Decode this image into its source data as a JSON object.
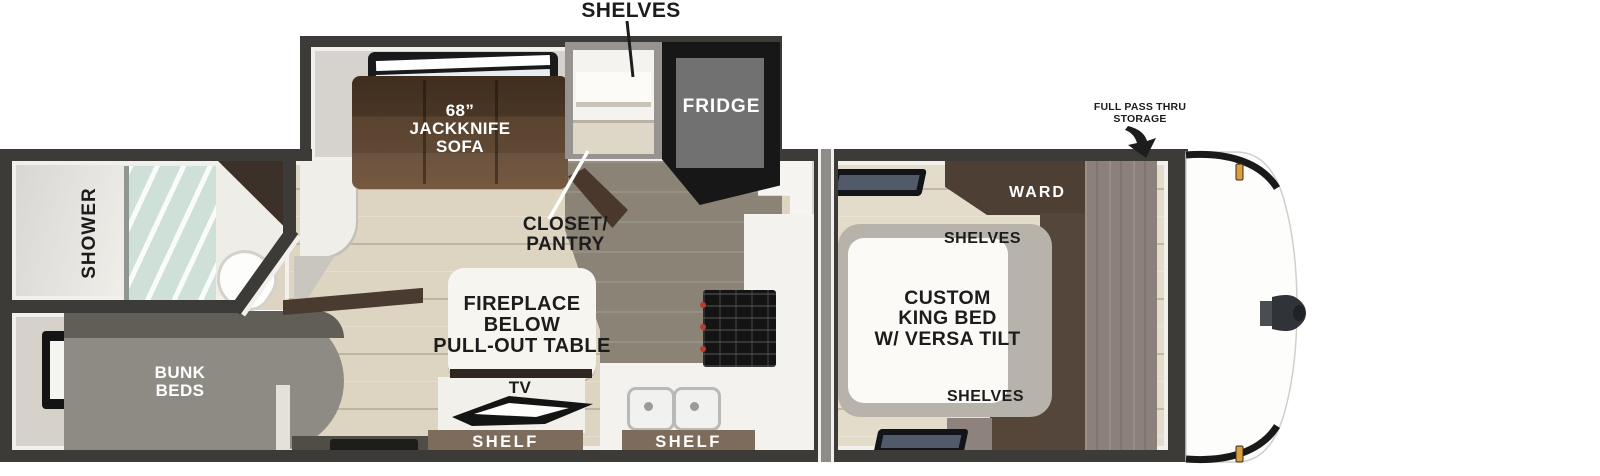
{
  "labels": {
    "shelves_callout": "SHELVES",
    "storage_callout": [
      "FULL PASS THRU",
      "STORAGE"
    ],
    "sofa": [
      "68”",
      "JACKKNIFE",
      "SOFA"
    ],
    "fridge": "FRIDGE",
    "closet": [
      "CLOSET/",
      "PANTRY"
    ],
    "shower": "SHOWER",
    "bunk": [
      "BUNK",
      "BEDS"
    ],
    "table": [
      "FIREPLACE",
      "BELOW",
      "PULL-OUT TABLE"
    ],
    "tv": "TV",
    "shelf_left": "SHELF",
    "shelf_right": "SHELF",
    "bed": [
      "CUSTOM",
      "KING BED",
      "W/ VERSA TILT"
    ],
    "ward": "WARD",
    "bed_shelves_top": "SHELVES",
    "bed_shelves_bottom": "SHELVES"
  },
  "colors": {
    "wall": "#3d3b38",
    "floor_beige": "#ddd5c2",
    "floor_dark": "#8b8476",
    "sofa_brown": "#5a4430",
    "shelf_brown": "#7d6b5b",
    "wood_dark": "#4e3f35",
    "wood_taupe": "#8b817a",
    "bunk_gray": "#8e8b85",
    "marker_amber": "#dc9f3f",
    "shower_glass": "#cfe0d8",
    "label_black": "#1c1c1c",
    "label_white": "#ffffff"
  }
}
